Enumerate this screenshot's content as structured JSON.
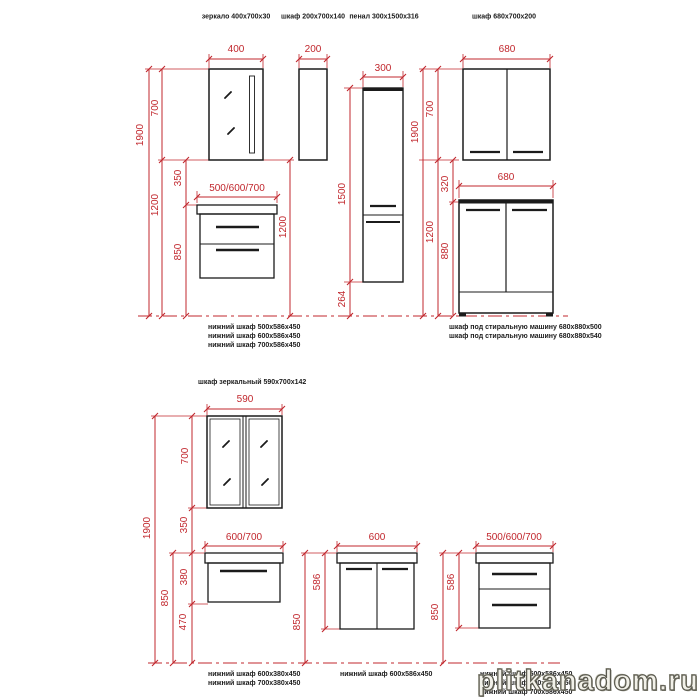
{
  "colors": {
    "dimension_red": "#c1272d",
    "drawing_ink": "#1b1b1b",
    "watermark_fill": "#f2f1e9",
    "watermark_outline": "#5a594e"
  },
  "watermark": "plitkanadom.ru",
  "top_row": {
    "product_labels": [
      "зеркало 400х700х30",
      "шкаф 200х700х140",
      "пенал 300х1500х316",
      "шкаф 680х700х200"
    ],
    "captions_left": [
      "нижний шкаф  500х586х450",
      "нижний шкаф  600х586х450",
      "нижний шкаф  700х586х450"
    ],
    "captions_right": [
      "шкаф под стиральную машину 680х880х500",
      "шкаф под стиральную машину 680х880х540"
    ]
  },
  "bottom_row": {
    "product_labels": [
      "шкаф зеркальный 590х700х142"
    ],
    "captions_left": [
      "нижний шкаф  600х380х450",
      "нижний шкаф  700х380х450"
    ],
    "captions_mid": [
      "нижний шкаф  600х586х450"
    ],
    "captions_right": [
      "нижний шкаф  500х586х450",
      "нижний шкаф  600х586х450",
      "нижний шкаф  700х586х450"
    ]
  },
  "dim_labels": [
    {
      "t": "400",
      "x": 236,
      "y": 50
    },
    {
      "t": "200",
      "x": 313,
      "y": 50
    },
    {
      "t": "300",
      "x": 383,
      "y": 69
    },
    {
      "t": "680",
      "x": 507,
      "y": 50
    },
    {
      "t": "500/600/700",
      "x": 237,
      "y": 189
    },
    {
      "t": "680",
      "x": 506,
      "y": 178
    },
    {
      "t": "1900",
      "x": 141,
      "y": 135,
      "r": 1
    },
    {
      "t": "700",
      "x": 156,
      "y": 108,
      "r": 1
    },
    {
      "t": "1200",
      "x": 156,
      "y": 205,
      "r": 1
    },
    {
      "t": "350",
      "x": 179,
      "y": 178,
      "r": 1
    },
    {
      "t": "850",
      "x": 179,
      "y": 252,
      "r": 1
    },
    {
      "t": "1200",
      "x": 284,
      "y": 227,
      "r": 1
    },
    {
      "t": "1500",
      "x": 343,
      "y": 194,
      "r": 1
    },
    {
      "t": "264",
      "x": 343,
      "y": 299,
      "r": 1
    },
    {
      "t": "1900",
      "x": 416,
      "y": 132,
      "r": 1
    },
    {
      "t": "700",
      "x": 431,
      "y": 109,
      "r": 1
    },
    {
      "t": "1200",
      "x": 431,
      "y": 232,
      "r": 1
    },
    {
      "t": "320",
      "x": 446,
      "y": 184,
      "r": 1
    },
    {
      "t": "880",
      "x": 446,
      "y": 251,
      "r": 1
    },
    {
      "t": "590",
      "x": 245,
      "y": 400
    },
    {
      "t": "600/700",
      "x": 244,
      "y": 538
    },
    {
      "t": "600",
      "x": 377,
      "y": 538
    },
    {
      "t": "500/600/700",
      "x": 514,
      "y": 538
    },
    {
      "t": "1900",
      "x": 148,
      "y": 528,
      "r": 1
    },
    {
      "t": "700",
      "x": 186,
      "y": 456,
      "r": 1
    },
    {
      "t": "350",
      "x": 185,
      "y": 525,
      "r": 1
    },
    {
      "t": "380",
      "x": 185,
      "y": 577,
      "r": 1
    },
    {
      "t": "470",
      "x": 184,
      "y": 622,
      "r": 1
    },
    {
      "t": "850",
      "x": 166,
      "y": 598,
      "r": 1
    },
    {
      "t": "586",
      "x": 318,
      "y": 582,
      "r": 1
    },
    {
      "t": "850",
      "x": 298,
      "y": 622,
      "r": 1
    },
    {
      "t": "586",
      "x": 452,
      "y": 582,
      "r": 1
    },
    {
      "t": "850",
      "x": 436,
      "y": 612,
      "r": 1
    }
  ]
}
